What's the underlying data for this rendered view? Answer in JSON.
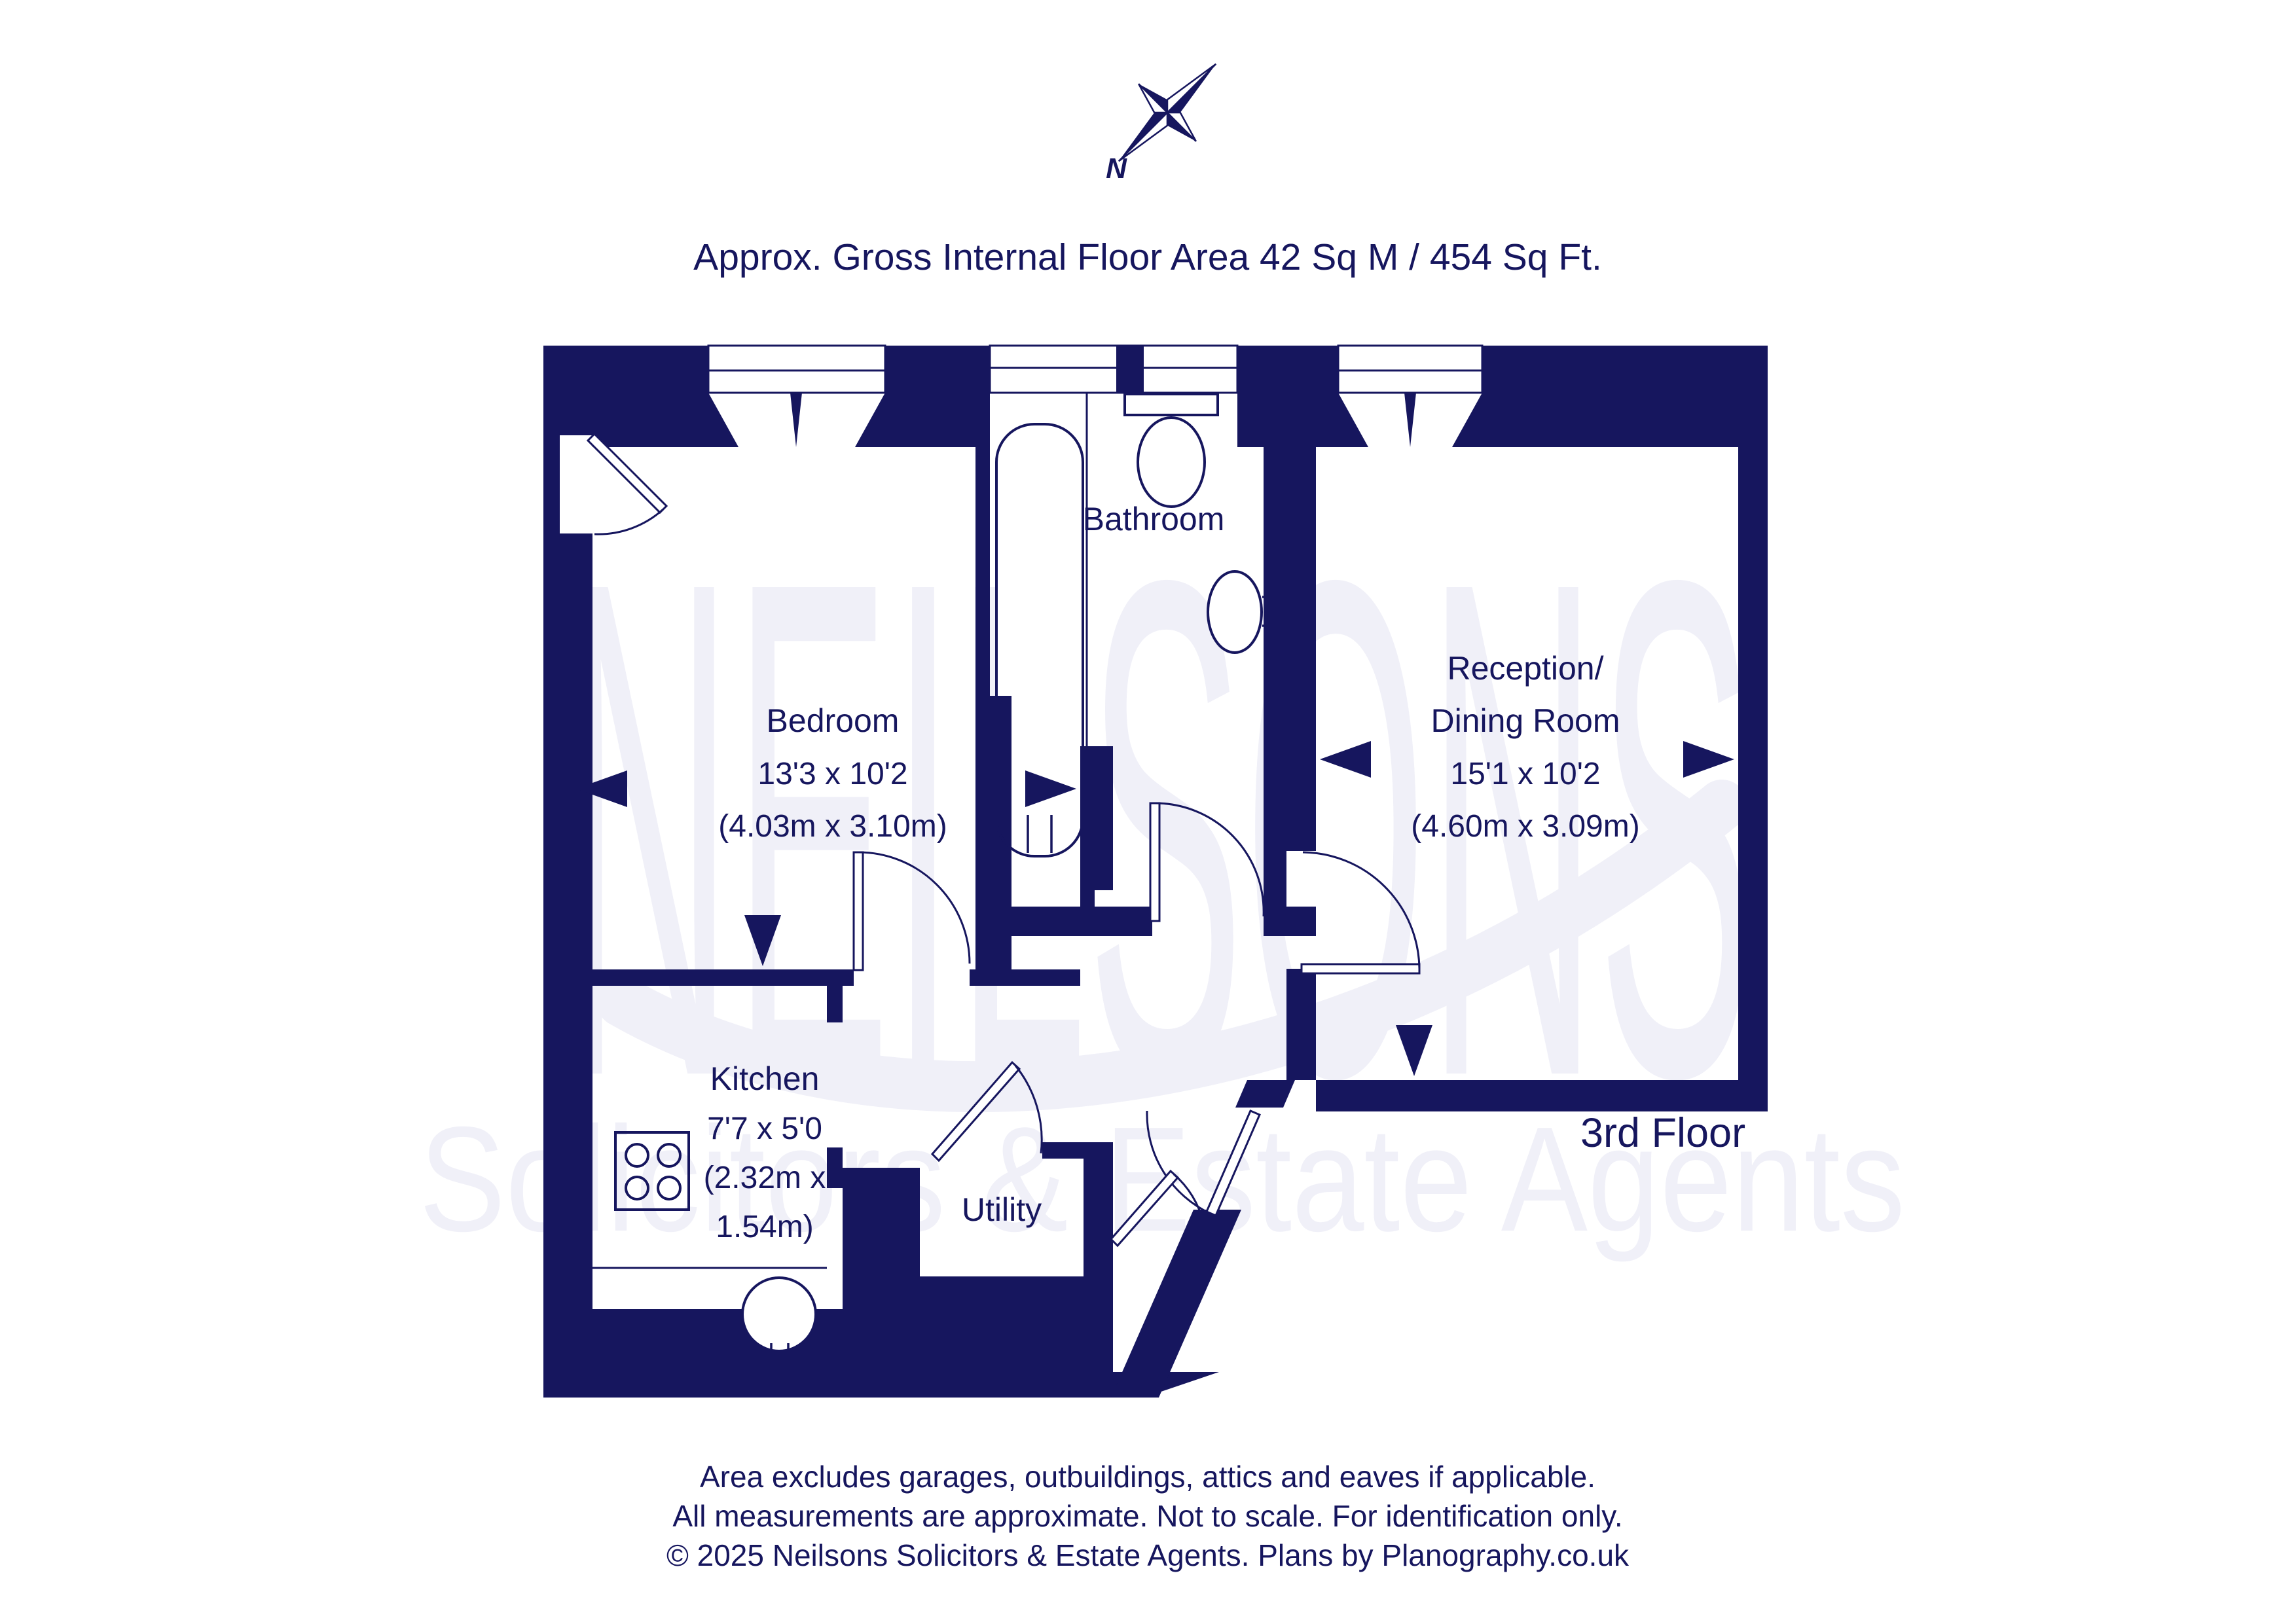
{
  "colors": {
    "navy": "#16165e",
    "watermark": "#f0f0f8",
    "background": "#ffffff"
  },
  "compass": {
    "north_label": "N"
  },
  "title": "Approx. Gross Internal Floor Area 42 Sq M / 454 Sq Ft.",
  "watermark": {
    "brand": "NEILSONS",
    "tagline": "Solicitors & Estate Agents"
  },
  "rooms": {
    "bedroom": {
      "name": "Bedroom",
      "imperial": "13'3 x 10'2",
      "metric": "(4.03m x 3.10m)"
    },
    "bathroom": {
      "name": "Bathroom"
    },
    "reception": {
      "name_line1": "Reception/",
      "name_line2": "Dining Room",
      "imperial": "15'1 x 10'2",
      "metric": "(4.60m x 3.09m)"
    },
    "kitchen": {
      "name": "Kitchen",
      "imperial": "7'7 x 5'0",
      "metric_line1": "(2.32m x",
      "metric_line2": "1.54m)"
    },
    "utility": {
      "name": "Utility"
    }
  },
  "floor_label": "3rd Floor",
  "footer": {
    "line1": "Area excludes garages, outbuildings, attics and eaves if applicable.",
    "line2": "All measurements are approximate. Not to scale. For identification only.",
    "line3": "© 2025 Neilsons Solicitors & Estate Agents. Plans by Planography.co.uk"
  }
}
